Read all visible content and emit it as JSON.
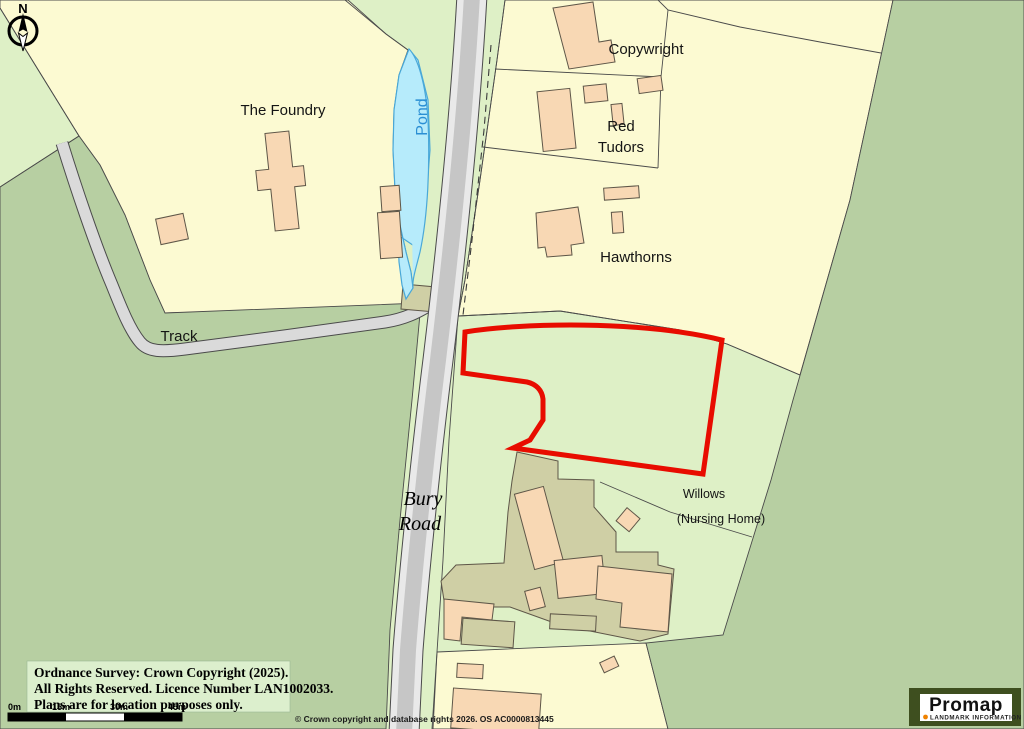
{
  "map": {
    "labels": {
      "foundry": "The Foundry",
      "pond": "Pond",
      "copywright": "Copywright",
      "red_tudors_line1": "Red",
      "red_tudors_line2": "Tudors",
      "hawthorns": "Hawthorns",
      "track": "Track",
      "bury_line1": "Bury",
      "bury_line2": "Road",
      "willows": "Willows",
      "nursing_home": "(Nursing Home)",
      "compass": "N"
    },
    "colors": {
      "field_yellow": "#fcfad2",
      "grass_pale_green": "#def0c6",
      "grass_medium_green": "#b7cfa2",
      "road_center": "#c6c6c6",
      "road_shoulder": "#e9e9e9",
      "track_gray": "#dadada",
      "building_peach": "#f8d8b4",
      "hardstanding_khaki": "#cfcfa5",
      "pond_fill": "#b6ebfb",
      "pond_outline": "#49a8d8",
      "pond_text": "#2b8fd4",
      "plot_boundary_red": "#e80c00",
      "parcel_line": "#4a4a4a",
      "legend_background": "#dcefcd",
      "promap_frame": "#3e4f1f",
      "promap_orange": "#ef8200"
    }
  },
  "legend_box": {
    "line1": "Ordnance Survey: Crown Copyright (2025).",
    "line2": "All Rights Reserved. Licence Number LAN1002033.",
    "line3": "Plans are for location purposes only."
  },
  "scale_bar": {
    "t0": "0m",
    "t15": "15m",
    "t30": "30m",
    "t45": "45m"
  },
  "footer": {
    "credit": "© Crown copyright and database rights 2026. OS AC0000813445"
  },
  "branding": {
    "name": "Promap",
    "tagline": "LANDMARK INFORMATION"
  }
}
